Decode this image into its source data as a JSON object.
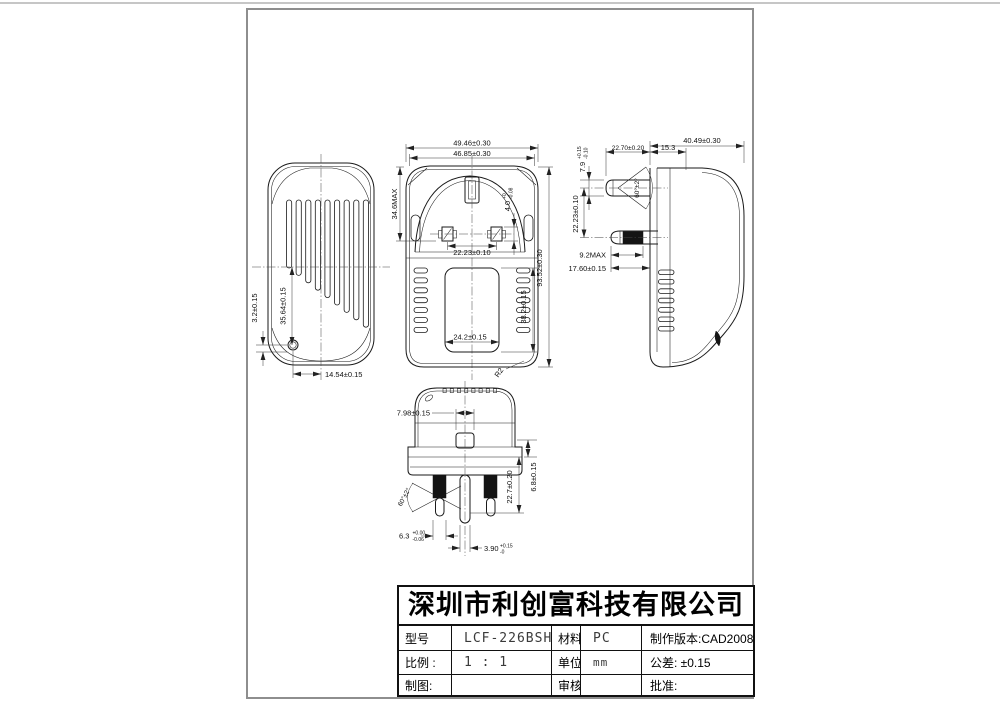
{
  "page": {
    "bg": "#ffffff",
    "frame_color": "#8e8e8e"
  },
  "title_block": {
    "company": "深圳市利创富科技有限公司",
    "rows": [
      {
        "c1": "型号",
        "c2": "LCF-226BSH",
        "c3": "材料:",
        "c4": "PC",
        "c5": "制作版本:CAD2008"
      },
      {
        "c1": "比例 :",
        "c2": "1 : 1",
        "c3": "单位:",
        "c4": "mm",
        "c5": "公差: ±0.15"
      },
      {
        "c1": "制图:",
        "c2": "",
        "c3": "审核:",
        "c4": "",
        "c5": "批准:"
      }
    ]
  },
  "views": {
    "back": {
      "led_offset": "3.2±0.15",
      "led_height": "35.64±0.15",
      "led_x": "14.54±0.15"
    },
    "front": {
      "width_outer": "49.46±0.30",
      "width_inner": "46.85±0.30",
      "plug_height": "34.6MAX",
      "pin_w": {
        "v": "4.0",
        "t": "+0",
        "b": "-0.08"
      },
      "pin_pitch": "22.23±0.10",
      "total_height": "93.52±0.30",
      "label_height": "38.2±0.15",
      "label_width": "24.2±0.15",
      "corner_radius": "R2"
    },
    "side": {
      "depth": "40.49±0.30",
      "earth_pin_len": "22.70±0.20",
      "face_depth": "15.3",
      "earth_pin_dia": {
        "v": "7.9",
        "t": "+0.15",
        "b": "-0.10"
      },
      "pin_spacing": "22.23±0.10",
      "pin_angle": "60°±2°",
      "sleeve_max": "9.2MAX",
      "live_pin_len": "17.60±0.15"
    },
    "bottom": {
      "fuse_width": "7.98±0.15",
      "pin_angle": "60°±2°",
      "pin_width": {
        "v": "6.3",
        "t": "+0.00",
        "b": "-0.06"
      },
      "earth_pin_width": {
        "v": "3.90",
        "t": "+0.15",
        "b": "-0"
      },
      "pin_length": "22.7±0.20",
      "step": "6.8±0.15"
    }
  }
}
